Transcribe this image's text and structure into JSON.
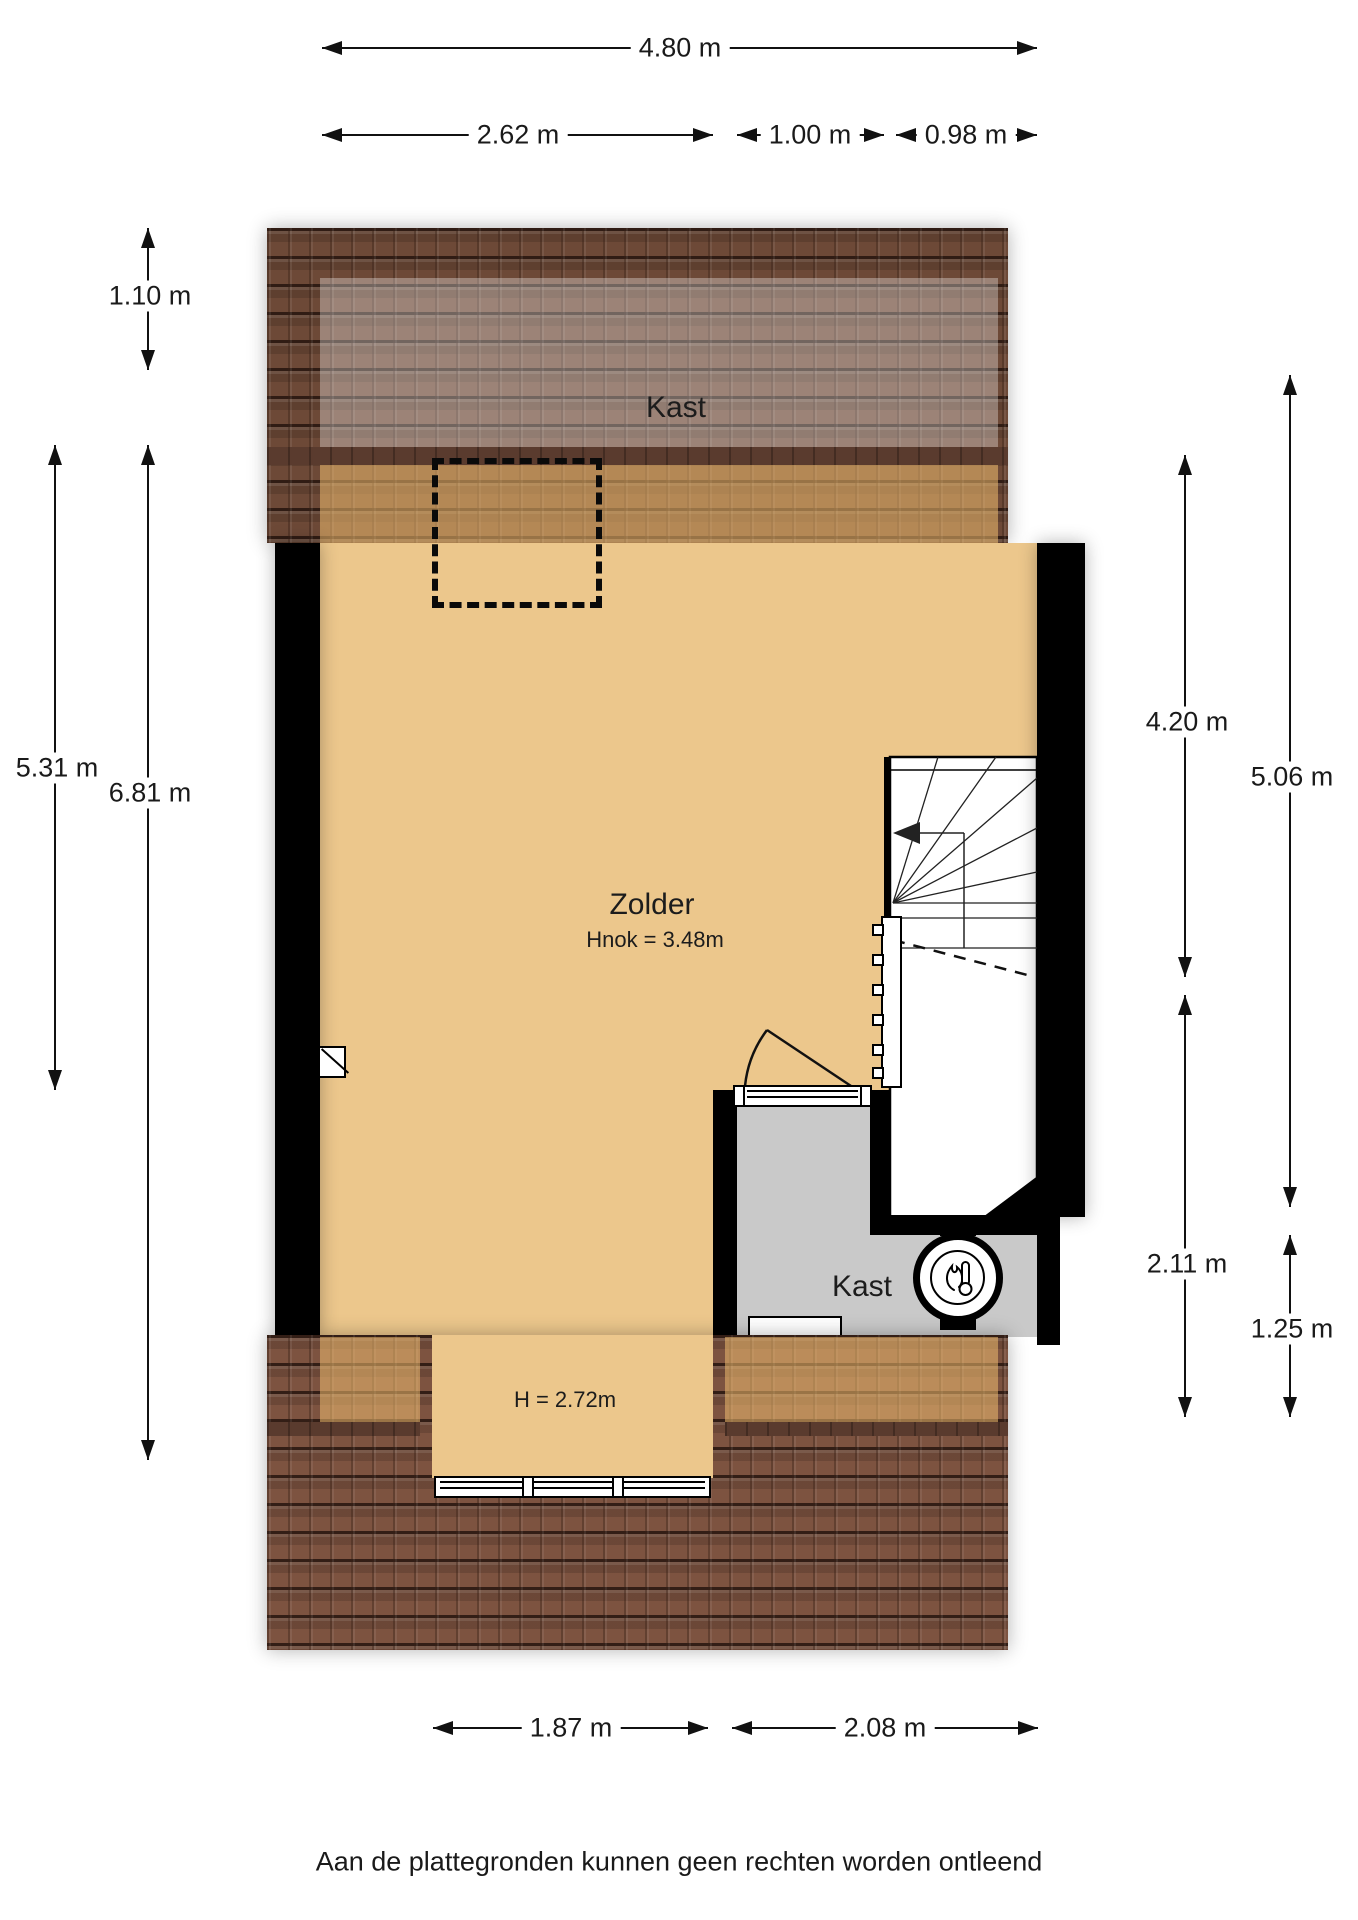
{
  "page": {
    "disclaimer": "Aan de plattegronden kunnen geen rechten worden ontleend"
  },
  "colors": {
    "floor_tan": "#ecc78c",
    "roof_brown_dark": "#6d4937",
    "roof_brown_light": "#7d5340",
    "closet_gray": "#c9c9c9",
    "wall_black": "#000000",
    "line_dark": "#111111"
  },
  "rooms": {
    "roof_storage_label": "Kast",
    "attic_label": "Zolder",
    "attic_ridge_height": "Hnok = 3.48m",
    "closet_label": "Kast",
    "dormer_height": "H = 2.72m"
  },
  "icons": {
    "boiler": "boiler-flame-thermometer-icon",
    "stairs_direction": "stairs-down-arrow-icon"
  },
  "dimensions": {
    "top_total": "4.80 m",
    "top_left": "2.62 m",
    "top_mid": "1.00 m",
    "top_right": "0.98 m",
    "left_roof": "1.10 m",
    "left_inner": "5.31 m",
    "left_total": "6.81 m",
    "right_upper": "4.20 m",
    "right_outer_upper": "5.06 m",
    "right_lower": "2.11 m",
    "right_outer_lower": "1.25 m",
    "bottom_left": "1.87 m",
    "bottom_right": "2.08 m"
  }
}
